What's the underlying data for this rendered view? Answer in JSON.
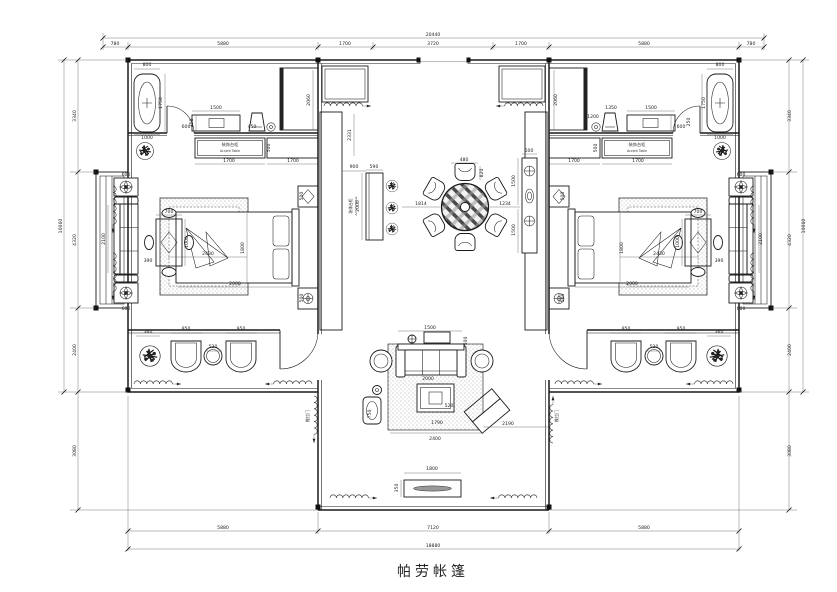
{
  "title": {
    "text": "帕劳帐篷"
  },
  "colors": {
    "line": "#1a1a1a",
    "background": "#ffffff"
  },
  "labels": [
    {
      "t": "装饰台柜",
      "x": 230,
      "y": 146,
      "s": 4.2
    },
    {
      "t": "Accent Table",
      "x": 230,
      "y": 152,
      "s": 3.2
    },
    {
      "t": "装饰台柜",
      "x": 637,
      "y": 146,
      "s": 4.2
    },
    {
      "t": "Accent Table",
      "x": 637,
      "y": 152,
      "s": 3.2
    },
    {
      "t": "装饰台柜",
      "x": 352,
      "y": 206,
      "s": 3.8,
      "r": -90
    },
    {
      "t": "Accent Table",
      "x": 357,
      "y": 206,
      "s": 3.0,
      "r": -90
    },
    {
      "t": "推拉门",
      "x": 309,
      "y": 416,
      "s": 4,
      "r": -90
    },
    {
      "t": "推拉门",
      "x": 558,
      "y": 416,
      "s": 4,
      "r": -90
    }
  ],
  "dims": [
    {
      "t": "780",
      "x": 115,
      "y": 45
    },
    {
      "t": "5880",
      "x": 223,
      "y": 45
    },
    {
      "t": "1700",
      "x": 345,
      "y": 45
    },
    {
      "t": "3720",
      "x": 433,
      "y": 45
    },
    {
      "t": "1700",
      "x": 521,
      "y": 45
    },
    {
      "t": "5880",
      "x": 644,
      "y": 45
    },
    {
      "t": "780",
      "x": 751,
      "y": 45
    },
    {
      "t": "20440",
      "x": 433,
      "y": 36
    },
    {
      "t": "5880",
      "x": 223,
      "y": 529
    },
    {
      "t": "7120",
      "x": 433,
      "y": 529
    },
    {
      "t": "5880",
      "x": 644,
      "y": 529
    },
    {
      "t": "18880",
      "x": 433,
      "y": 547
    },
    {
      "t": "3340",
      "x": 76,
      "y": 116,
      "r": -90
    },
    {
      "t": "4320",
      "x": 76,
      "y": 240,
      "r": -90
    },
    {
      "t": "2400",
      "x": 76,
      "y": 350,
      "r": -90
    },
    {
      "t": "3080",
      "x": 76,
      "y": 451,
      "r": -90
    },
    {
      "t": "10060",
      "x": 62,
      "y": 226,
      "r": -90
    },
    {
      "t": "3340",
      "x": 791,
      "y": 116,
      "r": -90
    },
    {
      "t": "4320",
      "x": 791,
      "y": 240,
      "r": -90
    },
    {
      "t": "2400",
      "x": 791,
      "y": 350,
      "r": -90
    },
    {
      "t": "3080",
      "x": 791,
      "y": 451,
      "r": -90
    },
    {
      "t": "10060",
      "x": 805,
      "y": 226,
      "r": -90
    },
    {
      "t": "800",
      "x": 147,
      "y": 66
    },
    {
      "t": "1750",
      "x": 162,
      "y": 103,
      "r": -90
    },
    {
      "t": "1000",
      "x": 147,
      "y": 139
    },
    {
      "t": "600",
      "x": 186,
      "y": 128
    },
    {
      "t": "1500",
      "x": 216,
      "y": 109
    },
    {
      "t": "350",
      "x": 193,
      "y": 123,
      "r": -90
    },
    {
      "t": "450",
      "x": 252,
      "y": 128
    },
    {
      "t": "500",
      "x": 270,
      "y": 148,
      "r": -90
    },
    {
      "t": "1700",
      "x": 229,
      "y": 162
    },
    {
      "t": "1700",
      "x": 293,
      "y": 162
    },
    {
      "t": "2060",
      "x": 310,
      "y": 100,
      "r": -90
    },
    {
      "t": "2430",
      "x": 208,
      "y": 255
    },
    {
      "t": "1800",
      "x": 244,
      "y": 248,
      "r": -90
    },
    {
      "t": "2000",
      "x": 235,
      "y": 285
    },
    {
      "t": "500",
      "x": 303,
      "y": 196,
      "r": -90
    },
    {
      "t": "500",
      "x": 303,
      "y": 298,
      "r": -90
    },
    {
      "t": "700",
      "x": 169,
      "y": 213
    },
    {
      "t": "1000",
      "x": 188,
      "y": 242,
      "r": -90
    },
    {
      "t": "390",
      "x": 148,
      "y": 262
    },
    {
      "t": "600",
      "x": 126,
      "y": 176
    },
    {
      "t": "2100",
      "x": 105,
      "y": 239,
      "r": -90
    },
    {
      "t": "600",
      "x": 126,
      "y": 310
    },
    {
      "t": "2331",
      "x": 351,
      "y": 135,
      "r": -90
    },
    {
      "t": "480",
      "x": 464,
      "y": 161
    },
    {
      "t": "820",
      "x": 483,
      "y": 173,
      "r": -90
    },
    {
      "t": "1814",
      "x": 421,
      "y": 205
    },
    {
      "t": "1234",
      "x": 505,
      "y": 205
    },
    {
      "t": "900",
      "x": 354,
      "y": 168
    },
    {
      "t": "590",
      "x": 374,
      "y": 168
    },
    {
      "t": "2000",
      "x": 359,
      "y": 206,
      "r": -90
    },
    {
      "t": "500",
      "x": 529,
      "y": 152
    },
    {
      "t": "1500",
      "x": 515,
      "y": 181,
      "r": -90
    },
    {
      "t": "1500",
      "x": 515,
      "y": 230,
      "r": -90
    },
    {
      "t": "1500",
      "x": 430,
      "y": 329
    },
    {
      "t": "500",
      "x": 467,
      "y": 341,
      "r": -90
    },
    {
      "t": "2000",
      "x": 428,
      "y": 380
    },
    {
      "t": "750",
      "x": 371,
      "y": 414,
      "r": -90
    },
    {
      "t": "520",
      "x": 449,
      "y": 407
    },
    {
      "t": "1790",
      "x": 437,
      "y": 424
    },
    {
      "t": "2400",
      "x": 435,
      "y": 440
    },
    {
      "t": "2190",
      "x": 508,
      "y": 425
    },
    {
      "t": "1800",
      "x": 432,
      "y": 470
    },
    {
      "t": "350",
      "x": 398,
      "y": 488,
      "r": -90
    },
    {
      "t": "360",
      "x": 148,
      "y": 333
    },
    {
      "t": "950",
      "x": 186,
      "y": 330
    },
    {
      "t": "520",
      "x": 213,
      "y": 348
    },
    {
      "t": "950",
      "x": 241,
      "y": 330
    },
    {
      "t": "950",
      "x": 626,
      "y": 330
    },
    {
      "t": "520",
      "x": 654,
      "y": 348
    },
    {
      "t": "950",
      "x": 681,
      "y": 330
    },
    {
      "t": "360",
      "x": 719,
      "y": 333
    },
    {
      "t": "2060",
      "x": 557,
      "y": 100,
      "r": -90
    },
    {
      "t": "1700",
      "x": 574,
      "y": 162
    },
    {
      "t": "1700",
      "x": 638,
      "y": 162
    },
    {
      "t": "1200",
      "x": 593,
      "y": 118
    },
    {
      "t": "1350",
      "x": 611,
      "y": 109
    },
    {
      "t": "1500",
      "x": 651,
      "y": 109
    },
    {
      "t": "250",
      "x": 690,
      "y": 122,
      "r": -90
    },
    {
      "t": "800",
      "x": 720,
      "y": 66
    },
    {
      "t": "1750",
      "x": 705,
      "y": 103,
      "r": -90
    },
    {
      "t": "1000",
      "x": 720,
      "y": 139
    },
    {
      "t": "600",
      "x": 681,
      "y": 128
    },
    {
      "t": "500",
      "x": 597,
      "y": 148,
      "r": -90
    },
    {
      "t": "2430",
      "x": 659,
      "y": 255
    },
    {
      "t": "1800",
      "x": 623,
      "y": 248,
      "r": -90
    },
    {
      "t": "2000",
      "x": 632,
      "y": 285
    },
    {
      "t": "500",
      "x": 564,
      "y": 196,
      "r": -90
    },
    {
      "t": "500",
      "x": 564,
      "y": 298,
      "r": -90
    },
    {
      "t": "700",
      "x": 698,
      "y": 213
    },
    {
      "t": "1000",
      "x": 679,
      "y": 242,
      "r": -90
    },
    {
      "t": "390",
      "x": 719,
      "y": 262
    },
    {
      "t": "600",
      "x": 741,
      "y": 176
    },
    {
      "t": "2100",
      "x": 762,
      "y": 239,
      "r": -90
    },
    {
      "t": "600",
      "x": 741,
      "y": 310
    }
  ]
}
